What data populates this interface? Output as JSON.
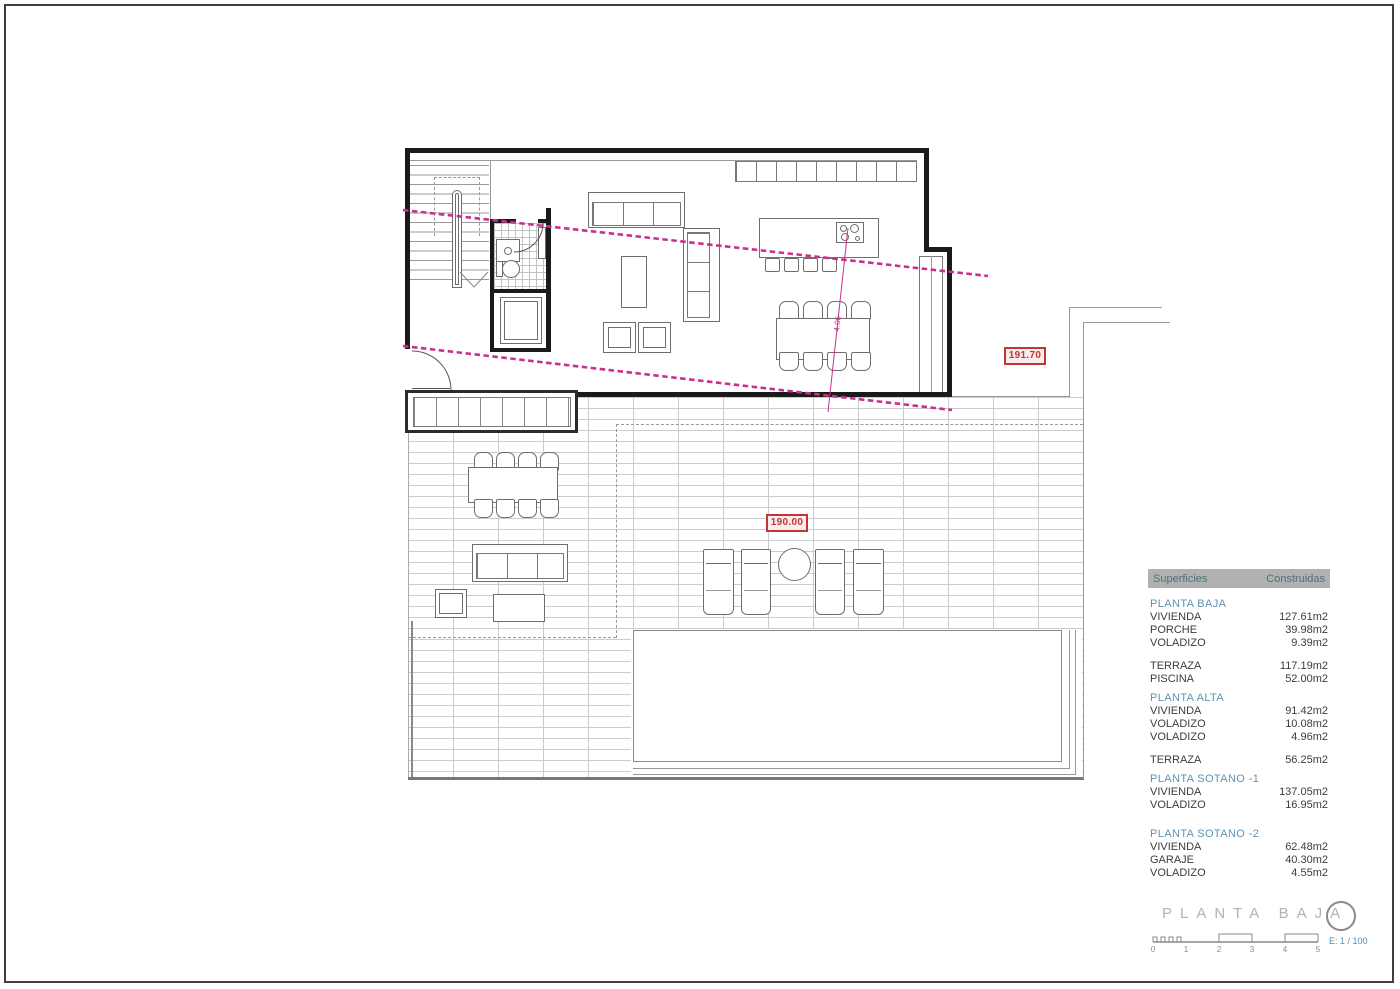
{
  "plan": {
    "elevation_labels": [
      {
        "text": "191.70"
      },
      {
        "text": "190.00"
      }
    ],
    "section_dim_label": "4.06"
  },
  "areas_table": {
    "header": {
      "col1": "Superficies",
      "col2": "Construidas"
    },
    "rows": [
      {
        "type": "section",
        "label": "PLANTA BAJA",
        "value": ""
      },
      {
        "type": "row",
        "label": "VIVIENDA",
        "value": "127.61m2"
      },
      {
        "type": "row",
        "label": "PORCHE",
        "value": "39.98m2"
      },
      {
        "type": "row",
        "label": "VOLADIZO",
        "value": "9.39m2"
      },
      {
        "type": "gap",
        "label": "",
        "value": ""
      },
      {
        "type": "row",
        "label": "TERRAZA",
        "value": "117.19m2"
      },
      {
        "type": "row",
        "label": "PISCINA",
        "value": "52.00m2"
      },
      {
        "type": "section",
        "label": "PLANTA ALTA",
        "value": ""
      },
      {
        "type": "row",
        "label": "VIVIENDA",
        "value": "91.42m2"
      },
      {
        "type": "row",
        "label": "VOLADIZO",
        "value": "10.08m2"
      },
      {
        "type": "row",
        "label": "VOLADIZO",
        "value": "4.96m2"
      },
      {
        "type": "gap",
        "label": "",
        "value": ""
      },
      {
        "type": "row",
        "label": "TERRAZA",
        "value": "56.25m2"
      },
      {
        "type": "section",
        "label": "PLANTA SOTANO -1",
        "value": ""
      },
      {
        "type": "row",
        "label": "VIVIENDA",
        "value": "137.05m2"
      },
      {
        "type": "row",
        "label": "VOLADIZO",
        "value": "16.95m2"
      },
      {
        "type": "gap",
        "label": "",
        "value": ""
      },
      {
        "type": "section",
        "label": "PLANTA SOTANO -2",
        "value": ""
      },
      {
        "type": "row",
        "label": "VIVIENDA",
        "value": "62.48m2"
      },
      {
        "type": "row",
        "label": "GARAJE",
        "value": "40.30m2"
      },
      {
        "type": "row",
        "label": "VOLADIZO",
        "value": "4.55m2"
      }
    ]
  },
  "titleblock": {
    "title": "PLANTA BAJA",
    "scale_label": "E: 1 / 100",
    "scale_ticks": [
      "0",
      "1",
      "2",
      "3",
      "4",
      "5"
    ]
  },
  "colors": {
    "accent_magenta": "#c9308c",
    "elev_red": "#bf3734",
    "table_blue": "#5d93b4",
    "scale_blue": "#4a8fc2",
    "title_gray": "#b3b3b3",
    "header_text": "#51707f"
  }
}
